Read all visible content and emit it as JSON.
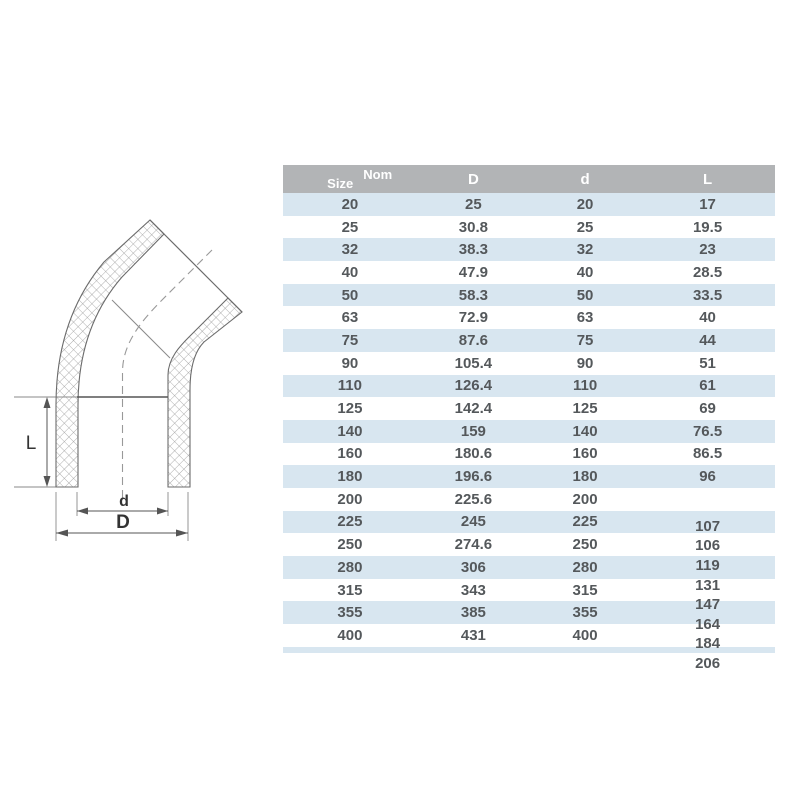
{
  "page": {
    "background": "#ffffff"
  },
  "diagram": {
    "description": "technical drawing of 45 degree elbow pipe fitting with crosshatched walls and dashed centerline",
    "labels": {
      "length": "L",
      "inner_diameter": "d",
      "outer_diameter": "D"
    }
  },
  "table": {
    "header": {
      "size": "Size",
      "nom": "Nom",
      "col_d_outer": "D",
      "col_d_inner": "d",
      "col_l": "L"
    },
    "rows": [
      [
        "20",
        "25",
        "20",
        "17"
      ],
      [
        "25",
        "30.8",
        "25",
        "19.5"
      ],
      [
        "32",
        "38.3",
        "32",
        "23"
      ],
      [
        "40",
        "47.9",
        "40",
        "28.5"
      ],
      [
        "50",
        "58.3",
        "50",
        "33.5"
      ],
      [
        "63",
        "72.9",
        "63",
        "40"
      ],
      [
        "75",
        "87.6",
        "75",
        "44"
      ],
      [
        "90",
        "105.4",
        "90",
        "51"
      ],
      [
        "110",
        "126.4",
        "110",
        "61"
      ],
      [
        "125",
        "142.4",
        "125",
        "69"
      ],
      [
        "140",
        "159",
        "140",
        "76.5"
      ],
      [
        "160",
        "180.6",
        "160",
        "86.5"
      ],
      [
        "180",
        "196.6",
        "180",
        "96"
      ],
      [
        "200",
        "225.6",
        "200",
        ""
      ],
      [
        "225",
        "245",
        "225",
        ""
      ],
      [
        "250",
        "274.6",
        "250",
        ""
      ],
      [
        "280",
        "306",
        "280",
        ""
      ],
      [
        "315",
        "343",
        "315",
        ""
      ],
      [
        "355",
        "385",
        "355",
        ""
      ],
      [
        "400",
        "431",
        "400",
        ""
      ]
    ],
    "l_tail": [
      "107",
      "106",
      "119",
      "131",
      "147",
      "164",
      "184",
      "206"
    ],
    "colors": {
      "header_bg": "#b2b4b6",
      "stripe_blue": "#d8e6f0",
      "row_white": "#ffffff",
      "cell_text": "#54585b",
      "header_text": "#ffffff"
    }
  }
}
